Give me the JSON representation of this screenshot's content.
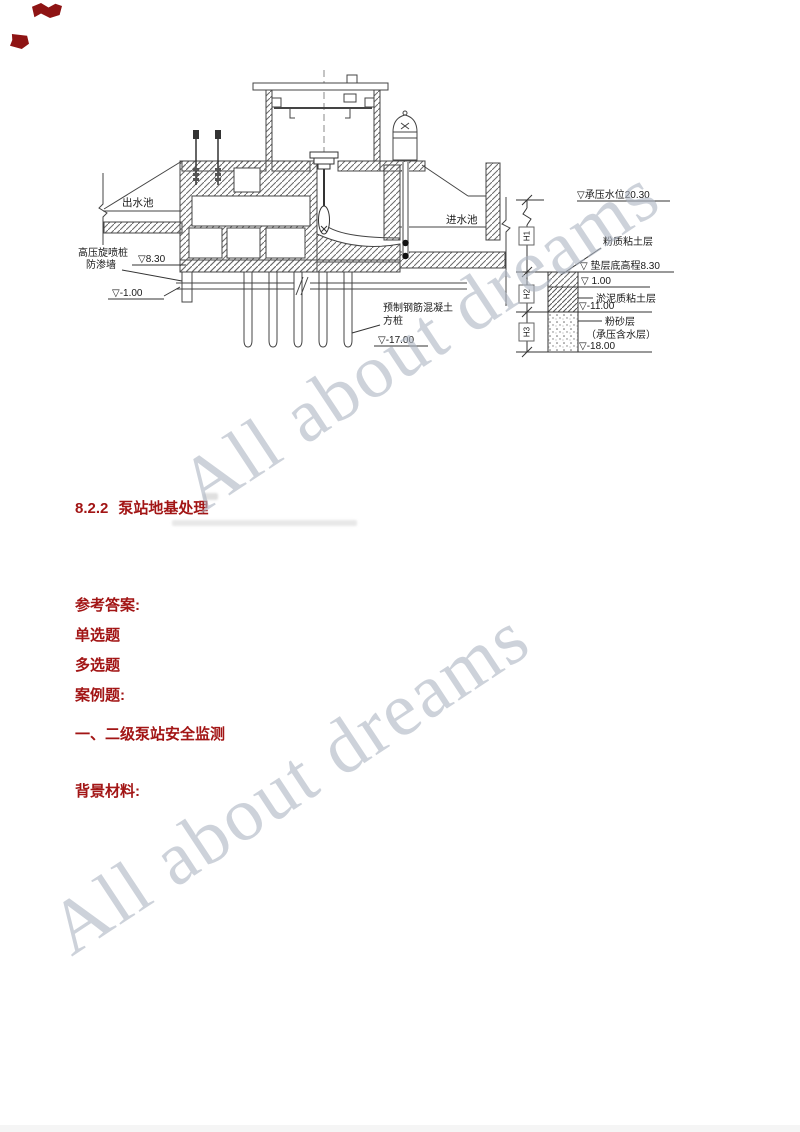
{
  "document": {
    "watermark": {
      "text": "All about dreams",
      "color": "#aeb6c4"
    },
    "heading": {
      "number": "8.2.2",
      "title": "泵站地基处理"
    },
    "red_lines": [
      {
        "text": "参考答案:"
      },
      {
        "text": "单选题"
      },
      {
        "text": "多选题"
      },
      {
        "text": "案例题:"
      },
      {
        "text": "一、二级泵站安全监测"
      },
      {
        "text": "背景材料:"
      }
    ]
  },
  "diagram": {
    "labels": {
      "outlet_pool": "出水池",
      "inlet_pool": "进水池",
      "jet_grouting_pile": "高压旋喷桩",
      "cutoff_wall": "防渗墙",
      "elev_8_30": "▽8.30",
      "elev_minus_1_00": "▽-1.00",
      "precast_pile_1": "预制钢筋混凝土",
      "precast_pile_2": "方桩",
      "elev_minus_17_00": "▽-17.00",
      "confined_water_level": "▽承压水位20.30",
      "silty_clay_layer": "粉质粘土层",
      "cushion_bottom_elev": "▽ 垫层底高程8.30",
      "elev_1_00": "▽ 1.00",
      "mucky_clay_layer": "淤泥质粘土层",
      "elev_minus_11_00": "▽-11.00",
      "silty_sand_layer": "粉砂层",
      "confined_aquifer": "（承压含水层）",
      "elev_minus_18_00": "▽-18.00",
      "dim_h1": "H1",
      "dim_h2": "H2",
      "dim_h3": "H3"
    }
  }
}
